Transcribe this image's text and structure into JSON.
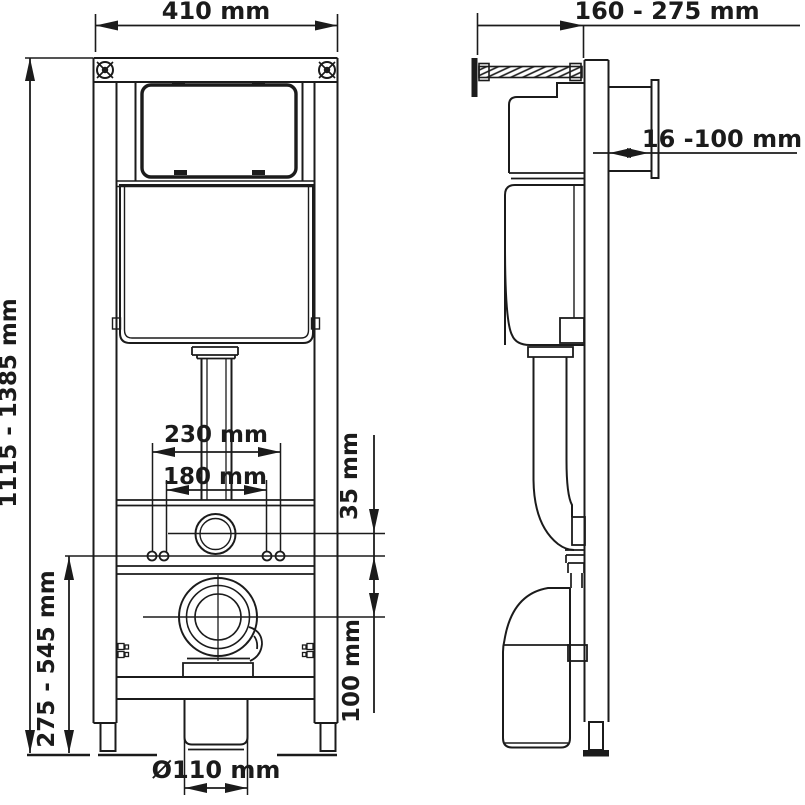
{
  "diagram": {
    "subject": "concealed-cistern-wc-frame-installation-drawing",
    "views": {
      "front_view": "front-view",
      "side_view": "side-view"
    },
    "dimensions": {
      "frame_width": "410 mm",
      "depth_range": "160 - 275 mm",
      "wall_offset_range": "16 -100 mm",
      "height_range": "1115 - 1385 mm",
      "fixing_spacing_outer": "230 mm",
      "fixing_spacing_inner": "180 mm",
      "supply_to_fixing_offset": "35 mm",
      "outlet_height_range": "275 - 545 mm",
      "fixing_to_outlet_offset": "100 mm",
      "outlet_diameter": "Ø110 mm"
    },
    "colors": {
      "line": "#1b1b1b",
      "background": "#ffffff"
    }
  }
}
